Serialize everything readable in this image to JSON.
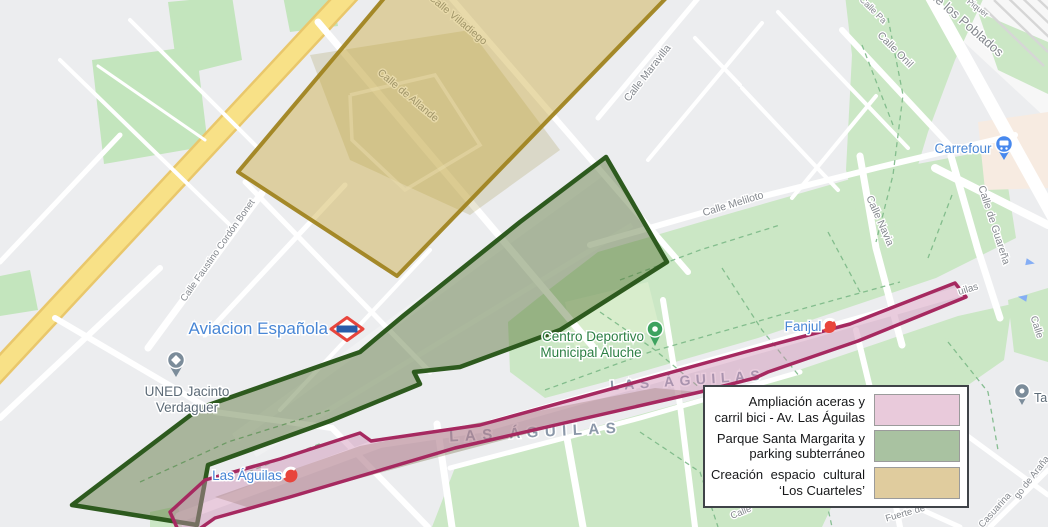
{
  "legend": {
    "items": [
      {
        "line1": "Ampliación aceras y",
        "line2": "carril bici - Av. Las Águilas",
        "color": "#e9cadb"
      },
      {
        "line1": "Parque Santa Margarita y",
        "line2": "parking subterráneo",
        "color": "#a9c2a1"
      },
      {
        "line1": "Creación espacio cultural",
        "line2": "‘Los Cuarteles’",
        "color": "#e0cc9e"
      }
    ]
  },
  "map": {
    "background": "#ecedef",
    "overlay_colors": {
      "cuarteles_fill": "#c8a835",
      "cuarteles_stroke": "#a08420",
      "parque_fill": "#4c6928",
      "parque_stroke": "#2d5a1e",
      "avenida_fill": "#cf8fb4",
      "avenida_stroke": "#a62960"
    },
    "districts": [
      {
        "name": "LAS ÁGUILAS"
      },
      {
        "name": "LAS ÁGUILAS"
      }
    ],
    "streets": [
      {
        "name": "Calle Villadiego"
      },
      {
        "name": "Calle de Allande"
      },
      {
        "name": "Calle Maravilla"
      },
      {
        "name": "Calle Meliloto"
      },
      {
        "name": "Calle Faustino Cordón Bonet"
      },
      {
        "name": "Calle Navia"
      },
      {
        "name": "Calle de Guareña"
      },
      {
        "name": "Calle Onil"
      },
      {
        "name": "de los Poblados"
      },
      {
        "name": "Piquer"
      },
      {
        "name": "Calle Pa"
      },
      {
        "name": "Calle"
      },
      {
        "name": "Casuarina"
      },
      {
        "name": "go de Araña"
      },
      {
        "name": "Fuerte de"
      },
      {
        "name": "Calle"
      },
      {
        "name": "uilas"
      }
    ],
    "stations": [
      {
        "name": "Aviacion Española"
      },
      {
        "name": "Fanjul"
      },
      {
        "name": "Las Águilas"
      }
    ],
    "pois": [
      {
        "line1": "UNED Jacinto",
        "line2": "Verdaguer"
      },
      {
        "line1": "Centro Deportivo",
        "line2": "Municipal Aluche"
      },
      {
        "name": "Carrefour"
      },
      {
        "name": "Ta"
      }
    ]
  }
}
